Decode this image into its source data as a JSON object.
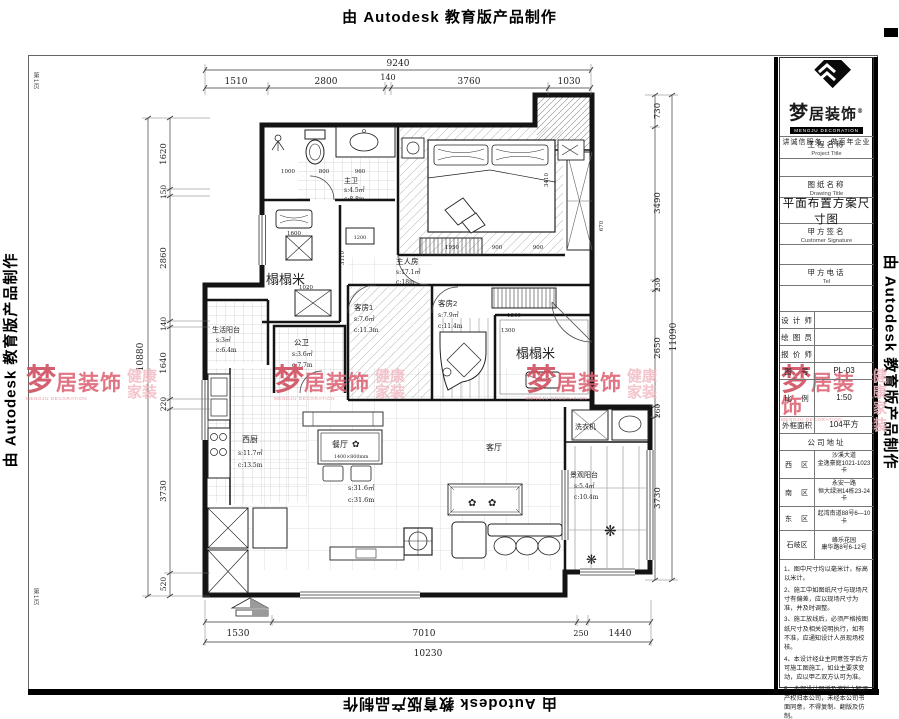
{
  "banner": {
    "text": "由 Autodesk 教育版产品制作",
    "page_mark": "第1页"
  },
  "watermark": {
    "meng": "梦",
    "rest": "居装饰",
    "caption": "MENGJU DECORATION",
    "tag1": "健康",
    "tag2": "家装",
    "color_primary": "#cf4a5c",
    "color_light": "#f2bcc4"
  },
  "title_block": {
    "logo_brand": "梦居装饰",
    "logo_reg": "®",
    "logo_caption": "MENGJU DECORATION",
    "slogan": "讲诚信服务　做百年企业",
    "project_label_cn": "工程名称",
    "project_label_en": "Project Title",
    "drawing_label_cn": "图纸名称",
    "drawing_label_en": "Drawing Title",
    "drawing_title": "平面布置方案尺寸图",
    "signature_label_cn": "甲方签名",
    "signature_label_en": "Customer Signature",
    "tel_label_cn": "甲方电话",
    "tel_label_en": "Tel",
    "designer_label": "设 计 师",
    "draftsman_label": "绘 图 员",
    "quoter_label": "报 价 师",
    "drawing_no_label": "图　号",
    "drawing_no": "PL-03",
    "scale_label": "比　例",
    "scale": "1:50",
    "area_label": "外框面积",
    "area_value": "104平方",
    "address_header": "公司地址",
    "addresses": [
      {
        "region": "西　区",
        "line1": "沙溪大道",
        "line2": "金逸豪庭1021-1023卡"
      },
      {
        "region": "南　区",
        "line1": "永安一路",
        "line2": "恒大绿洲14栋23-24卡"
      },
      {
        "region": "东　区",
        "line1": "起湾南道88号6—10卡",
        "line2": ""
      },
      {
        "region": "石岐区",
        "line1": "峰乐花园",
        "line2": "康华路8号6-12号"
      }
    ],
    "notes": [
      "1、图中尺寸均以毫米计，标高以米计。",
      "2、施工中如图纸尺寸与现场尺寸有偏差，应以现场尺寸为准，并及时调整。",
      "3、施工放线后，必须严格按图纸尺寸及相关说明执行，如有不准，应通知设计人员现场校核。",
      "4、本设计经业主同意签字后方可施工图施工，如业主要求变动，应以甲乙双方认可为准。",
      "5、全部设计图纸及资料之知识产权归本公司，未经本公司书面同意，不得复制、翻版及仿制。"
    ]
  },
  "dims": {
    "top_total": "9240",
    "top_segments": [
      "1510",
      "2800",
      "140",
      "3760",
      "1030"
    ],
    "left_total": "10880",
    "left_segments": [
      "1620",
      "150",
      "2860",
      "140",
      "1640",
      "220",
      "3730",
      "520"
    ],
    "right_total": "11090",
    "right_segments": [
      "730",
      "3490",
      "230",
      "2650",
      "260",
      "3730"
    ],
    "bottom_total": "10230",
    "bottom_segments": [
      "1530",
      "7010",
      "250",
      "1440"
    ],
    "inner": {
      "bath": [
        "1000",
        "800",
        "960"
      ],
      "tatami": [
        "1600",
        "3110",
        "1020",
        "1200"
      ],
      "bedroom": [
        "1950",
        "900",
        "900",
        "3410",
        "670"
      ],
      "entry": [
        "1360",
        "1300"
      ]
    }
  },
  "rooms": {
    "master_bath": {
      "name": "主卫",
      "s": "s:4.5㎡",
      "c": "c:8.8m"
    },
    "tatami_left": {
      "name": "榻榻米"
    },
    "master_bedroom": {
      "name": "主人房",
      "s": "s:17.1㎡",
      "c": "c:18m"
    },
    "guest1": {
      "name": "客房1",
      "s": "s:7.6㎡",
      "c": "c:11.3m"
    },
    "guest2": {
      "name": "客房2",
      "s": "s:7.9㎡",
      "c": "c:11.4m"
    },
    "tatami_right": {
      "name": "榻榻米"
    },
    "guest_bath": {
      "name": "公卫",
      "s": "s:3.6㎡",
      "c": "c:7.7m"
    },
    "service_balcony": {
      "name": "生活阳台",
      "s": "s:3㎡",
      "c": "c:6.4m"
    },
    "kitchen": {
      "name": "西厨",
      "s": "s:11.7㎡",
      "c": "c:13.5m"
    },
    "dining": {
      "name": "餐厅",
      "table_size": "1400×800mm"
    },
    "living": {
      "name": "客厅",
      "s": "s:31.6㎡",
      "c": "c:31.6m"
    },
    "laundry": {
      "name": "洗衣机"
    },
    "view_balcony": {
      "name": "景观阳台",
      "s": "s:5.4㎡",
      "c": "c:10.4m"
    }
  },
  "icons": {
    "flower": "✿",
    "plant": "❋"
  }
}
